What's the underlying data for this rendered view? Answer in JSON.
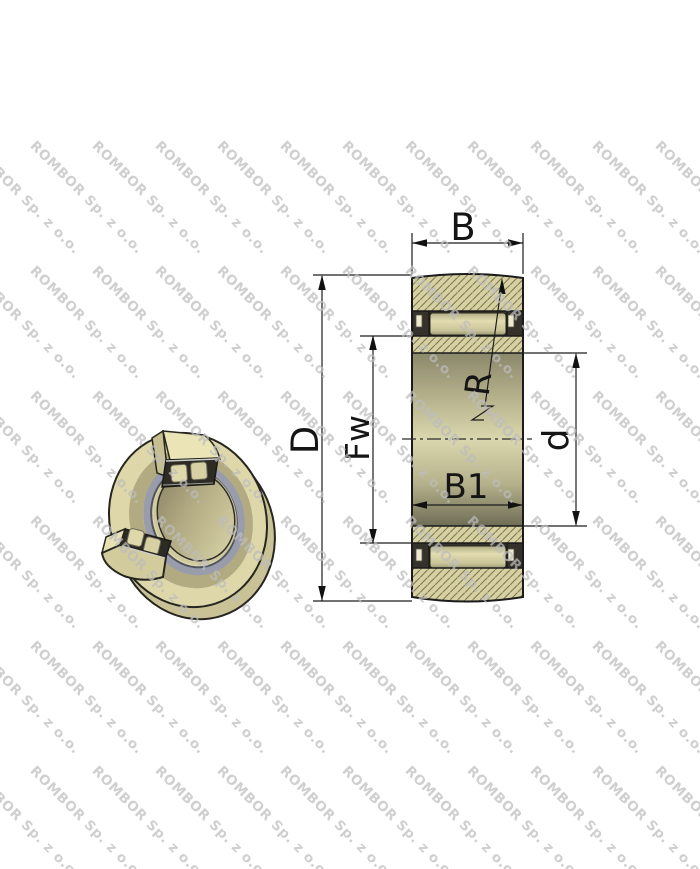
{
  "watermark": {
    "text": "ROMBOR Sp. z o.o.",
    "color": "#bdbdbd"
  },
  "drawing": {
    "type": "needle roller bearing cross-section with 3D cutaway view",
    "labels": {
      "B": "B",
      "D": "D",
      "Fw": "Fw",
      "d": "d",
      "B1": "B1",
      "R": "R"
    },
    "colors": {
      "body_tan": "#d7d1a2",
      "hatch_line": "#7c7756",
      "outline": "#1b1b1b",
      "pocket_dark": "#34322a",
      "roller_tan": "#ded8ab",
      "seal_gray": "#989cab",
      "background": "#ffffff"
    }
  }
}
